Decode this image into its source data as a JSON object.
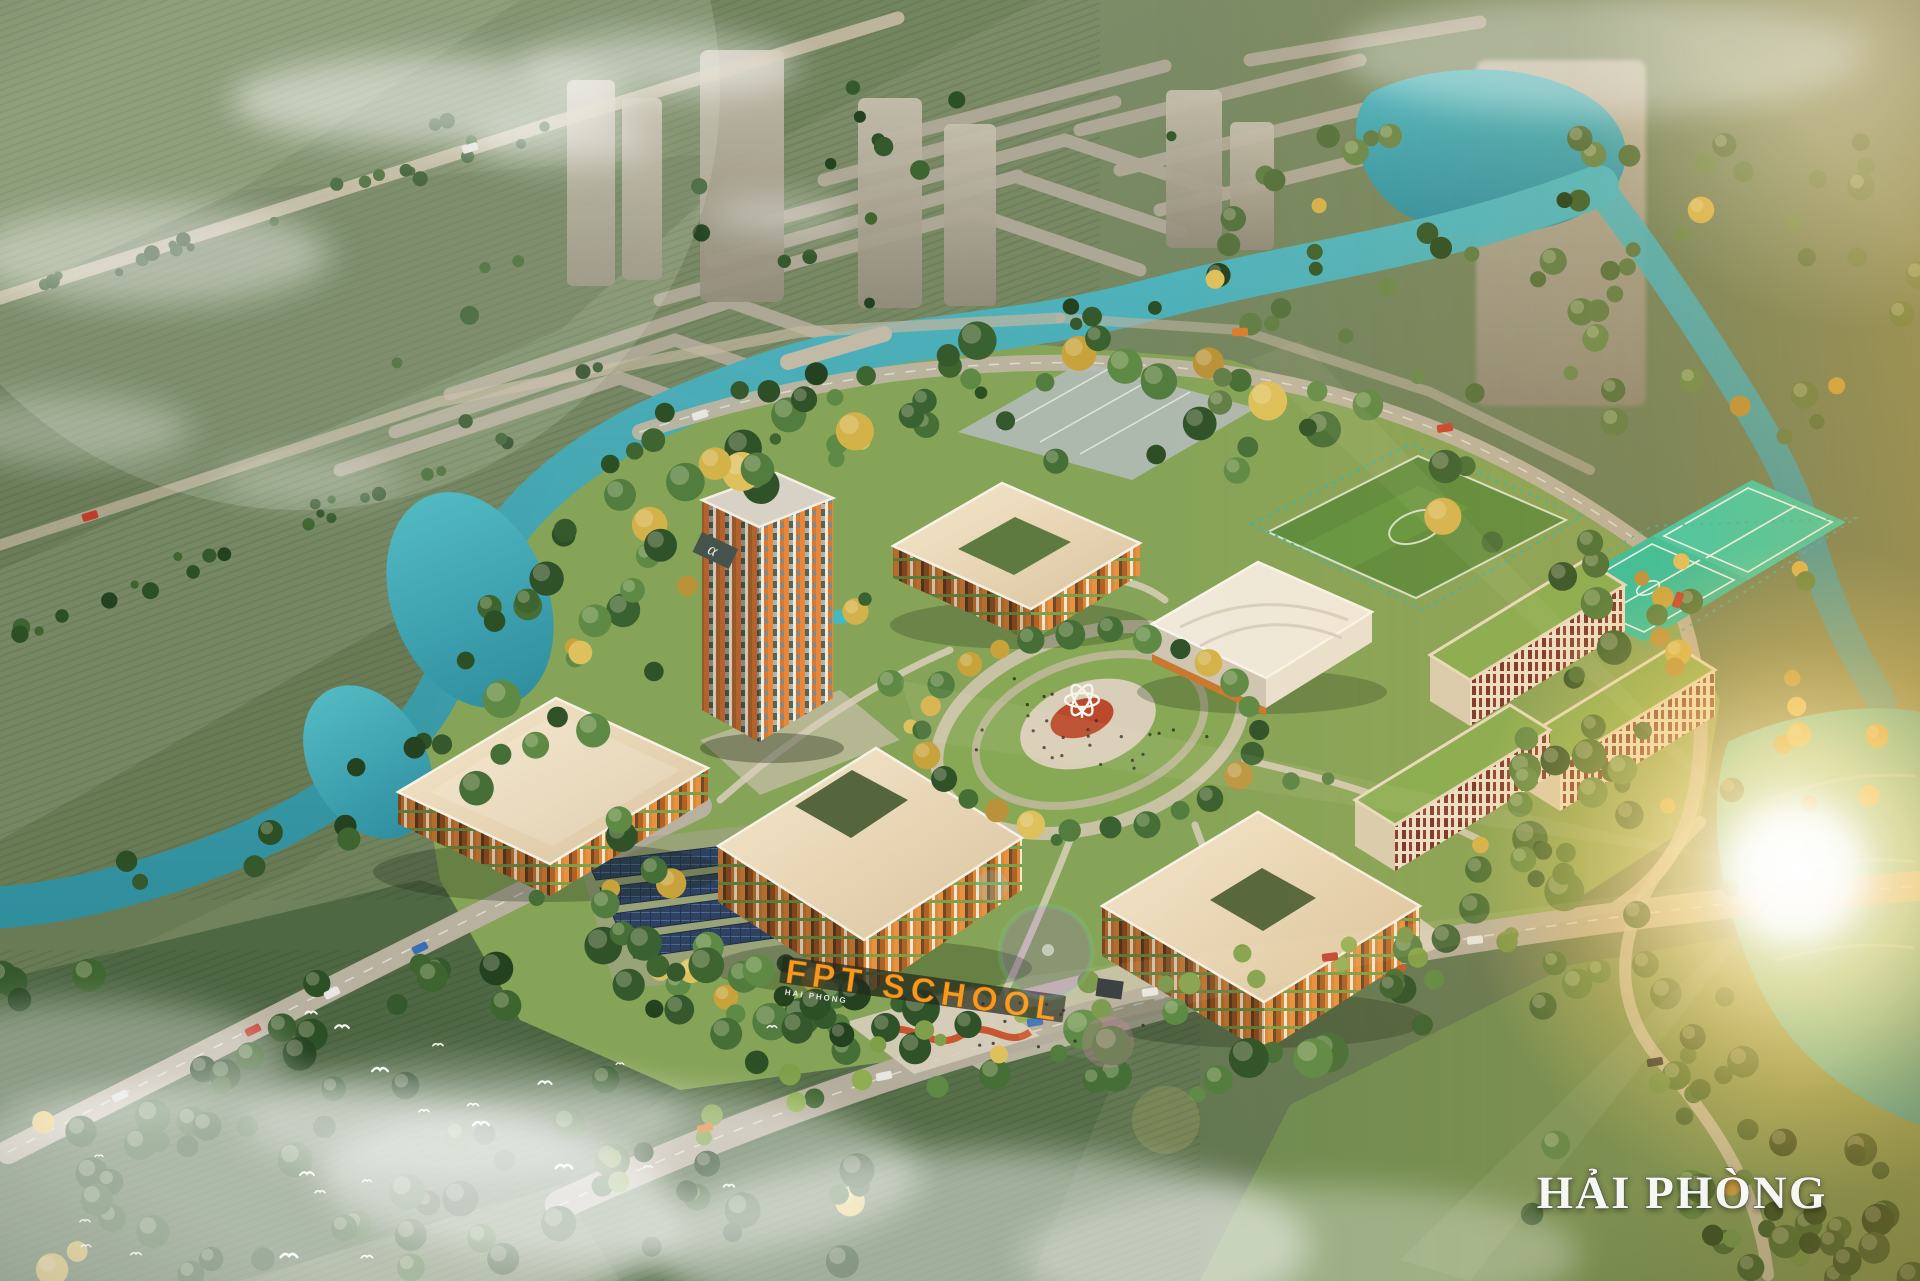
{
  "scene": {
    "type": "aerial-architectural-render",
    "subject": "Bird's-eye 3D masterplan rendering of a green school campus surrounded by rivers, farmland and a sunlit lake at golden hour",
    "entrance_sign": "FPT SCHOOL",
    "entrance_sign_sub": "HAI PHONG",
    "tower_logo": "α",
    "location_watermark": "HẢI PHÒNG"
  },
  "colors": {
    "base_field_green": "#758761",
    "dark_forest": "#30512a",
    "campus_lawn": "#86a458",
    "river_teal": "#3aa9b6",
    "lake_sunlit_teal": "#43c1bb",
    "roof_cream": "#eeddbd",
    "facade_orange": "#e0812f",
    "dorm_panel_red": "#7e352a",
    "green_roof": "#85ad52",
    "sport_court_teal": "#2fbfa0",
    "soccer_turf": "#5c8c3e",
    "city_ghost_gray": "#ada798",
    "road_tan": "#bdb5a2",
    "solar_panel_blue": "#2e4160",
    "playground_red": "#c64a20",
    "sun_glow_gold": "#ffd470",
    "sign_orange": "#f59a1e",
    "watermark_white": "#ffffff",
    "bird_white": "#ffffff"
  }
}
